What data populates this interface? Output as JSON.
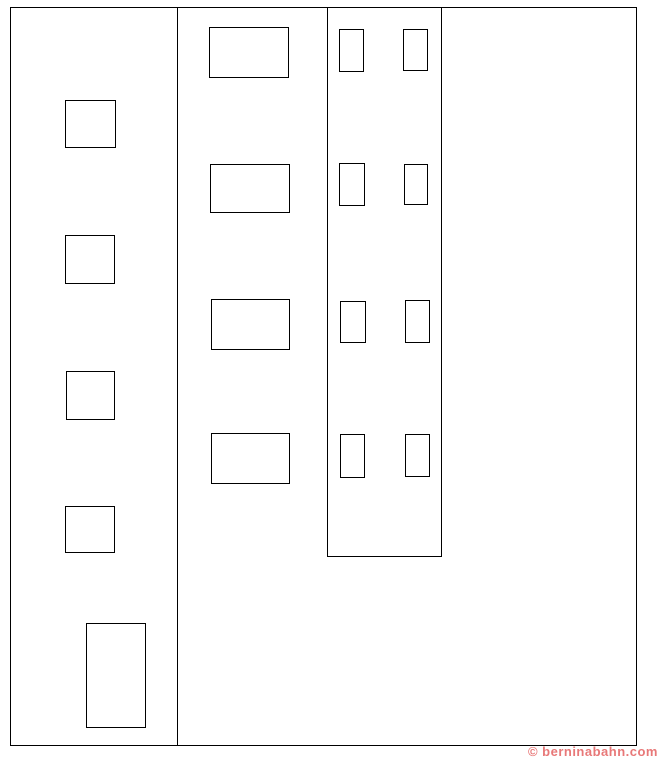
{
  "diagram": {
    "stroke_color": "#000000",
    "background_color": "#ffffff",
    "outer_box": {
      "x": 10,
      "y": 7,
      "w": 627,
      "h": 739
    },
    "left_panel_divider": {
      "x": 177,
      "y": 7,
      "h": 739
    },
    "inner_panel": {
      "x": 327,
      "y": 7,
      "w": 115,
      "h": 550
    },
    "left_column_squares": [
      {
        "x": 65,
        "y": 100,
        "w": 51,
        "h": 48
      },
      {
        "x": 65,
        "y": 235,
        "w": 50,
        "h": 49
      },
      {
        "x": 66,
        "y": 371,
        "w": 49,
        "h": 49
      },
      {
        "x": 65,
        "y": 506,
        "w": 50,
        "h": 47
      },
      {
        "x": 86,
        "y": 623,
        "w": 60,
        "h": 105
      }
    ],
    "middle_column_rects": [
      {
        "x": 209,
        "y": 27,
        "w": 80,
        "h": 51
      },
      {
        "x": 210,
        "y": 164,
        "w": 80,
        "h": 49
      },
      {
        "x": 211,
        "y": 299,
        "w": 79,
        "h": 51
      },
      {
        "x": 211,
        "y": 433,
        "w": 79,
        "h": 51
      }
    ],
    "inner_panel_rects": [
      {
        "x": 339,
        "y": 29,
        "w": 25,
        "h": 43
      },
      {
        "x": 403,
        "y": 29,
        "w": 25,
        "h": 42
      },
      {
        "x": 339,
        "y": 163,
        "w": 26,
        "h": 43
      },
      {
        "x": 404,
        "y": 164,
        "w": 24,
        "h": 41
      },
      {
        "x": 340,
        "y": 301,
        "w": 26,
        "h": 42
      },
      {
        "x": 405,
        "y": 300,
        "w": 25,
        "h": 43
      },
      {
        "x": 340,
        "y": 434,
        "w": 25,
        "h": 44
      },
      {
        "x": 405,
        "y": 434,
        "w": 25,
        "h": 43
      }
    ]
  },
  "watermark": {
    "text": "© berninabahn.com",
    "color": "#e87878"
  }
}
